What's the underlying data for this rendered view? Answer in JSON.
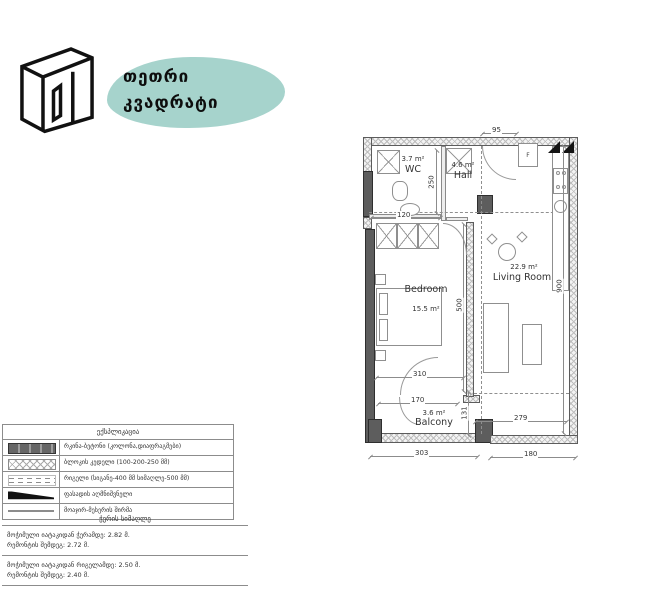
{
  "logo": {
    "line1": "თეთრი",
    "line2": "კვადრატი"
  },
  "colors": {
    "accent_teal": "#a6d3cc",
    "wall_dark": "#5d5d5d",
    "line_gray": "#8c8c8c"
  },
  "plan": {
    "rooms": {
      "wc": {
        "area": "3.7 m²",
        "name": "WC"
      },
      "hall": {
        "area": "4.6 m²",
        "name": "Hall"
      },
      "bedroom": {
        "name": "Bedroom",
        "area": "15.5 m²"
      },
      "living": {
        "area": "22.9 m²",
        "name": "Living Room"
      },
      "balcony": {
        "area": "3.6 m²",
        "name": "Balcony"
      }
    },
    "dims": {
      "top": "95",
      "wc_height": "250",
      "wc_width": "120",
      "bedroom_height": "500",
      "right_height": "900",
      "bedroom_width": "310",
      "balcony_width": "170",
      "balcony_height": "131",
      "living_width": "279",
      "bottom_left": "303",
      "bottom_right": "180"
    },
    "fridge_label": "F"
  },
  "legend": {
    "title": "ექსპლიკაცია",
    "rows": [
      {
        "symbol": "concrete",
        "label": "რკინა-ბეტონი (კოლონა,დიაფრაგმები)"
      },
      {
        "symbol": "block-wall",
        "label": "ბლოკის კედელი (100-200-250 მმ)"
      },
      {
        "symbol": "beam",
        "label": "რიგელი (სიგანე-400 მმ სიმაღლე-500 მმ)"
      },
      {
        "symbol": "facade-marker",
        "label": "ფასადის აღმნიშვნელი"
      },
      {
        "symbol": "railing",
        "label": "მოაჯირ-მესერის შირმა"
      }
    ]
  },
  "ceiling": {
    "title": "ჭერის სიმაღლე",
    "items": [
      {
        "line1": "მოჭიმული იატაკიდან ჭერამდე: 2.82 მ.",
        "line2": "რემონტის შემდეგ: 2.72 მ."
      },
      {
        "line1": "მოჭიმული იატაკიდან რიგელამდე: 2.50 მ.",
        "line2": "რემონტის შემდეგ: 2.40 მ."
      }
    ]
  }
}
